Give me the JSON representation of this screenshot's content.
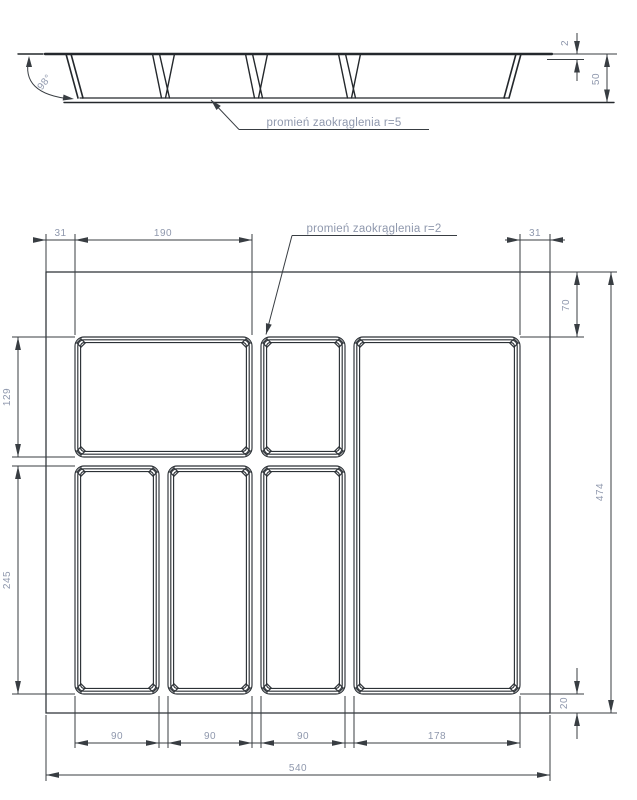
{
  "section": {
    "angle_label": "98°",
    "rim_thickness": "2",
    "total_height": "50",
    "radius_note": "promień zaokrąglenia r=5"
  },
  "plan": {
    "radius_note": "promień zaokrąglenia r=2",
    "top_margin_left": "31",
    "top_width": "190",
    "top_margin_right": "31",
    "right_top_offset": "70",
    "total_height": "474",
    "right_bottom_offset": "20",
    "left_row1_height": "129",
    "left_row2_height": "245",
    "col1": "90",
    "col2": "90",
    "col3": "90",
    "col4": "178",
    "total_width": "540"
  },
  "colors": {
    "line": "#24282c",
    "dim_text": "#8f98ad"
  }
}
